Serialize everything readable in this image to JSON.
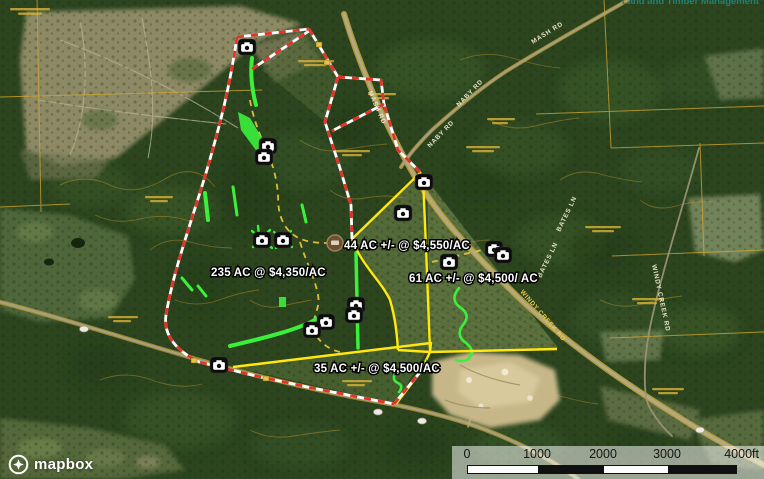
{
  "attribution": "Land and Timber Management",
  "branding": {
    "logo_text": "mapbox"
  },
  "map": {
    "parcel_labels": [
      {
        "id": "parcel-235",
        "label": "235 AC @ $4,350/AC"
      },
      {
        "id": "parcel-44",
        "label": "44 AC +/- @ $4,550/AC"
      },
      {
        "id": "parcel-61",
        "label": "61 AC +/- @ $4,500/ AC"
      },
      {
        "id": "parcel-35",
        "label": "35 AC +/- @ $4,500/AC"
      }
    ],
    "road_labels": {
      "naby_rd": "NABY RD",
      "mash_rd": "MASH RD",
      "bates_ln": "BATES LN",
      "windy_creek_rd": "WINDY CREEK RD"
    },
    "markers": {
      "trail_camera_count": 15,
      "trail_camera_icon": "camera-icon",
      "poi_marker": "brown-circle-poi"
    },
    "overlay_colors": {
      "boundary_dashed_red": "#e53228",
      "boundary_dashed_white": "#ffffff",
      "parcel_line_yellow": "#ffe70f",
      "trail_dashed_yellow": "#e6c43c",
      "food_plot_green": "#3bf03b"
    }
  },
  "scale_bar": {
    "ticks": [
      "0",
      "1000",
      "2000",
      "3000"
    ],
    "end_label": "4000ft"
  }
}
